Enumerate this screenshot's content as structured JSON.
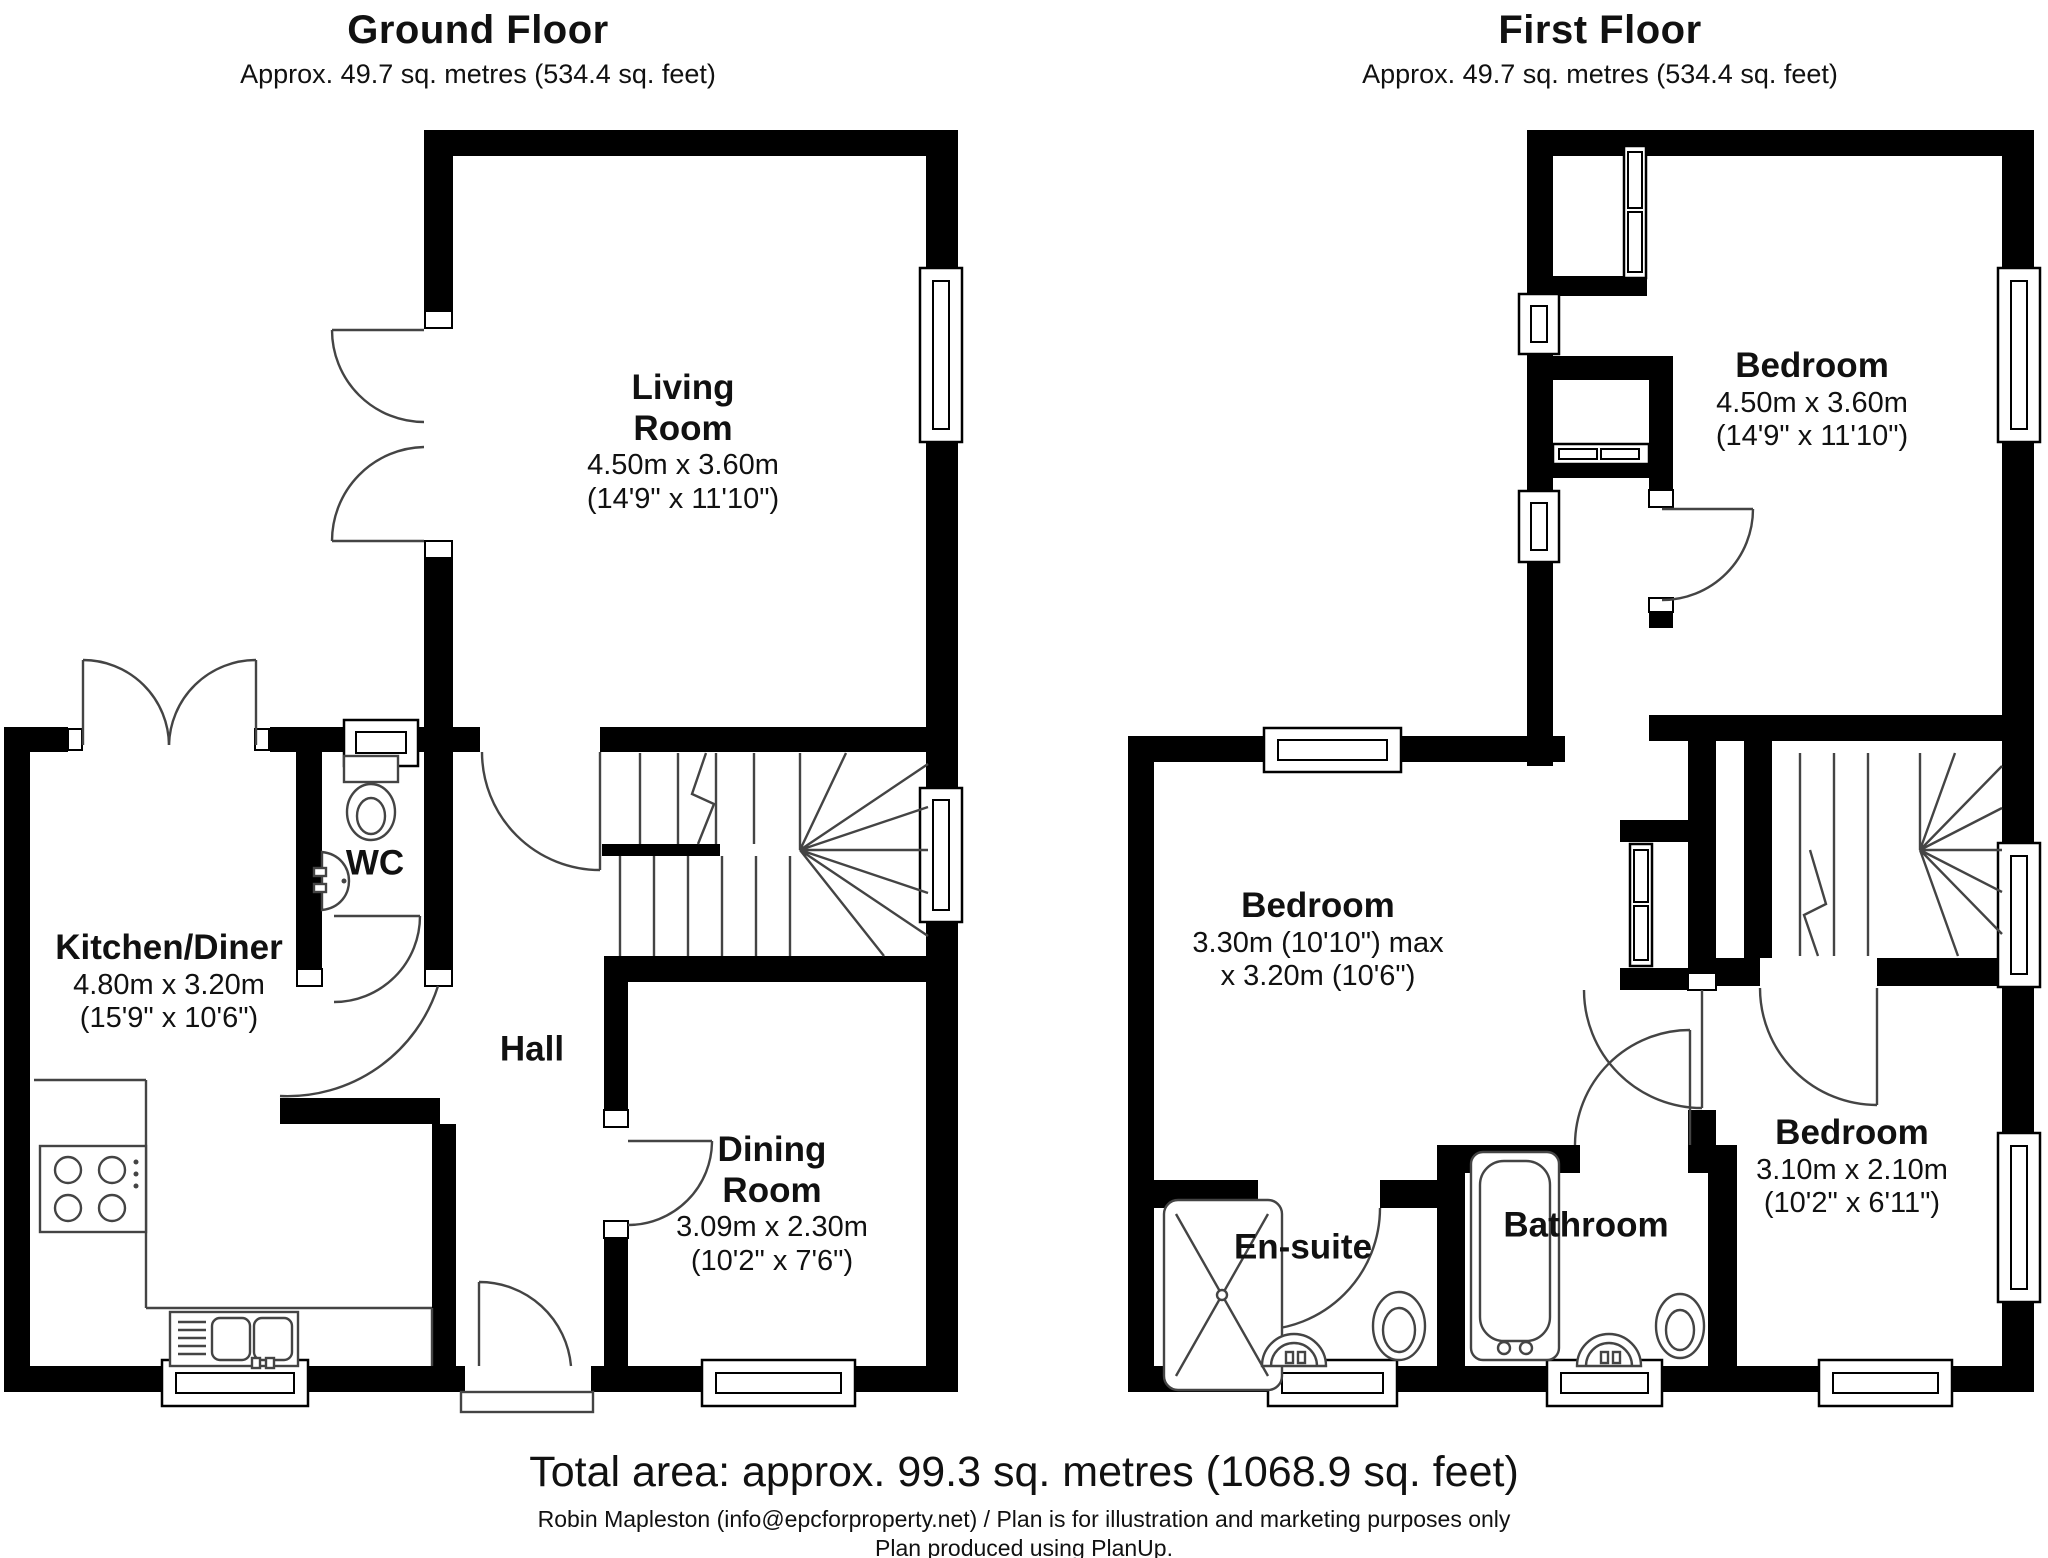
{
  "ground_floor": {
    "title": "Ground Floor",
    "subtitle": "Approx. 49.7 sq. metres (534.4 sq. feet)",
    "living_room": {
      "line1": "Living",
      "line2": "Room",
      "metric": "4.50m x 3.60m",
      "imperial": "(14'9\" x 11'10\")"
    },
    "kitchen_diner": {
      "name": "Kitchen/Diner",
      "metric": "4.80m x 3.20m",
      "imperial": "(15'9\" x 10'6\")"
    },
    "wc": {
      "name": "WC"
    },
    "hall": {
      "name": "Hall"
    },
    "dining_room": {
      "line1": "Dining",
      "line2": "Room",
      "metric": "3.09m x 2.30m",
      "imperial": "(10'2\" x 7'6\")"
    }
  },
  "first_floor": {
    "title": "First Floor",
    "subtitle": "Approx. 49.7 sq. metres (534.4 sq. feet)",
    "bedroom_master": {
      "name": "Bedroom",
      "metric": "4.50m x 3.60m",
      "imperial": "(14'9\" x 11'10\")"
    },
    "bedroom_two": {
      "name": "Bedroom",
      "metric": "3.30m (10'10\") max",
      "imperial": "x 3.20m (10'6\")"
    },
    "bedroom_three": {
      "name": "Bedroom",
      "metric": "3.10m x 2.10m",
      "imperial": "(10'2\" x 6'11\")"
    },
    "en_suite": {
      "name": "En-suite"
    },
    "bathroom": {
      "name": "Bathroom"
    }
  },
  "footer": {
    "total_area": "Total area: approx. 99.3 sq. metres (1068.9 sq. feet)",
    "attribution": "Robin Mapleston (info@epcforproperty.net) / Plan is for illustration and marketing purposes only",
    "produced": "Plan produced using PlanUp."
  },
  "colors": {
    "wall": "#000000",
    "line": "#444444",
    "background": "#ffffff"
  }
}
